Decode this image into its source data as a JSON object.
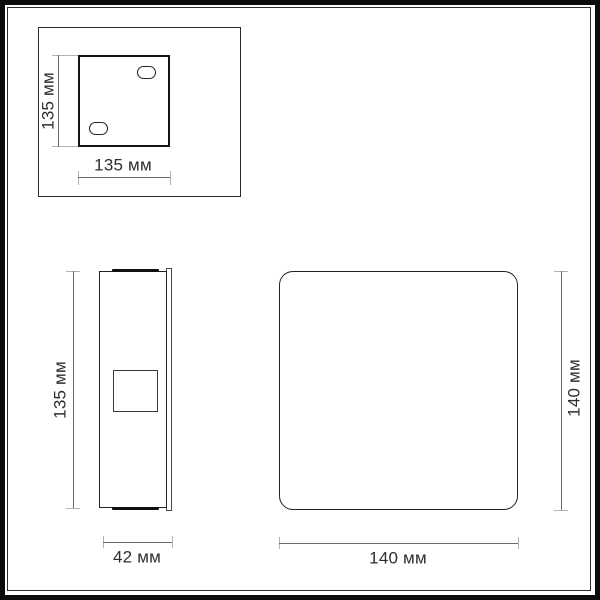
{
  "diagram": {
    "kind": "product-dimension-drawing",
    "unit": "мм",
    "views": {
      "back_plate": {
        "title": "mounting-plate-top-view",
        "height_label": "135 мм",
        "width_label": "135 мм",
        "height_mm": 135,
        "width_mm": 135
      },
      "side": {
        "title": "side-view",
        "height_label": "135 мм",
        "depth_label": "42 мм",
        "height_mm": 135,
        "depth_mm": 42
      },
      "front": {
        "title": "front-view",
        "height_label": "140 мм",
        "width_label": "140 мм",
        "height_mm": 140,
        "width_mm": 140
      }
    },
    "colors": {
      "outline": "#222222",
      "bold_outline": "#141414",
      "dimension_line": "#6b6b6b",
      "extension_line": "#b3b3b3",
      "label_text": "#2e2e2e",
      "background": "#ffffff",
      "frame": "#0c0c0c"
    }
  }
}
